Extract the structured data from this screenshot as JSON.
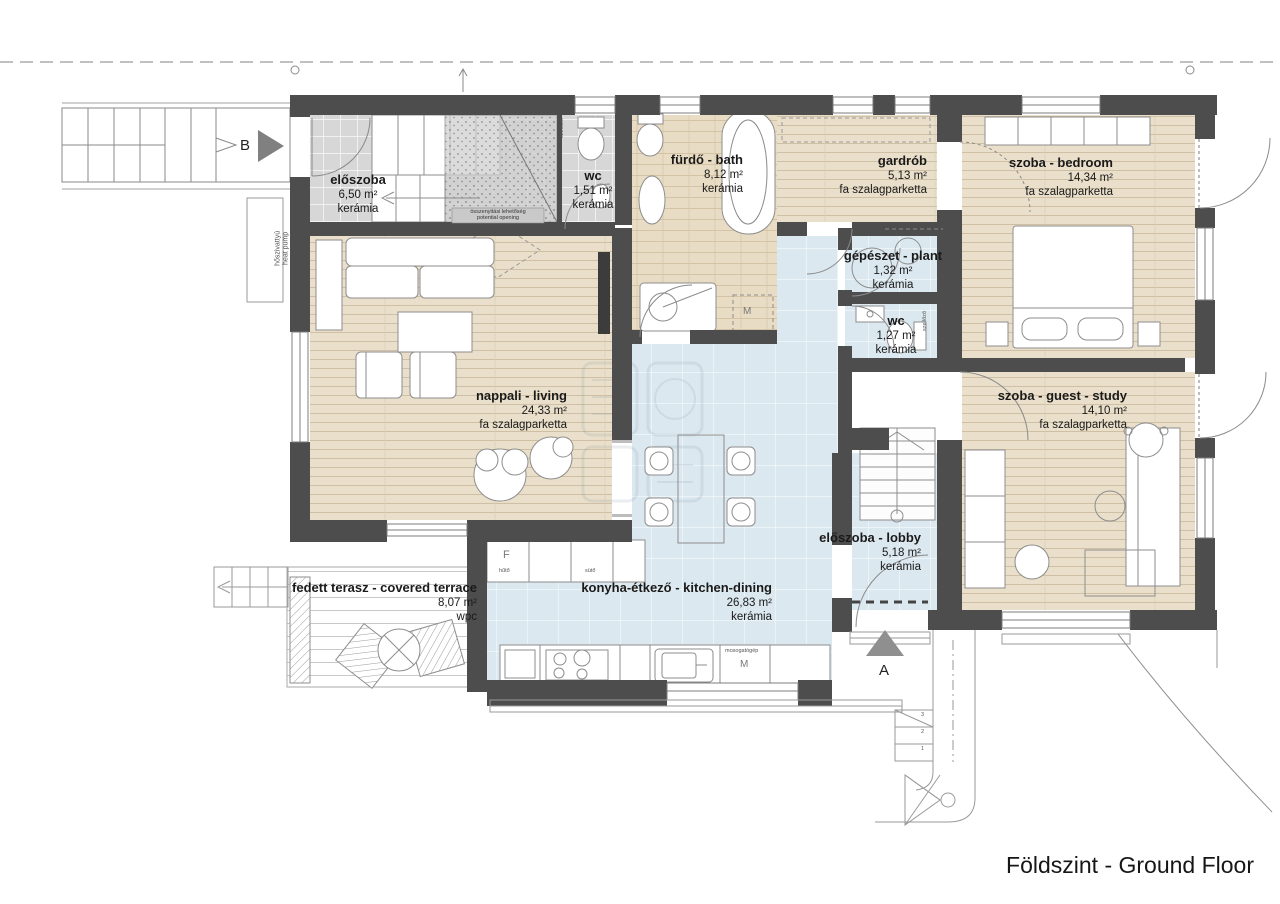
{
  "title": "Földszint - Ground Floor",
  "rooms": [
    {
      "id": "eloszoba",
      "name": "előszoba",
      "area": "6,50 m²",
      "floor": "kerámia"
    },
    {
      "id": "wc1",
      "name": "wc",
      "area": "1,51 m²",
      "floor": "kerámia"
    },
    {
      "id": "furdo",
      "name": "fürdő - bath",
      "area": "8,12 m²",
      "floor": "kerámia"
    },
    {
      "id": "gardrob",
      "name": "gardrób",
      "area": "5,13 m²",
      "floor": "fa szalagparketta"
    },
    {
      "id": "bedroom",
      "name": "szoba - bedroom",
      "area": "14,34 m²",
      "floor": "fa szalagparketta"
    },
    {
      "id": "gepeszet",
      "name": "gépészet - plant",
      "area": "1,32 m²",
      "floor": "kerámia"
    },
    {
      "id": "wc2",
      "name": "wc",
      "area": "1,27 m²",
      "floor": "kerámia"
    },
    {
      "id": "nappali",
      "name": "nappali - living",
      "area": "24,33 m²",
      "floor": "fa szalagparketta"
    },
    {
      "id": "guest",
      "name": "szoba - guest - study",
      "area": "14,10 m²",
      "floor": "fa szalagparketta"
    },
    {
      "id": "lobby",
      "name": "előszoba - lobby",
      "area": "5,18 m²",
      "floor": "kerámia"
    },
    {
      "id": "kitchen",
      "name": "konyha-étkező - kitchen-dining",
      "area": "26,83 m²",
      "floor": "kerámia"
    },
    {
      "id": "terasz",
      "name": "fedett terasz - covered terrace",
      "area": "8,07 m²",
      "floor": "wpc"
    }
  ],
  "markers": {
    "section": "B",
    "entrance": "A"
  },
  "annotations": {
    "heat_pump_line1": "hőszivattyú",
    "heat_pump_line2": "heat pump",
    "opening_line1": "összenyitási lehetőség",
    "opening_line2": "potential opening",
    "vent": "szellőző",
    "fridge_letter": "F",
    "fridge": "hűtő",
    "oven": "sütő",
    "dishwasher": "mosogatógép",
    "dishwasher_letter": "M",
    "washer_letter": "M",
    "step_numbers": [
      "1",
      "2",
      "3"
    ]
  },
  "colors": {
    "wall": "#4d4d4d",
    "wood": "#eadfca",
    "ceramic_gray": "#d7d7d7",
    "ceramic_blue": "#dce8ef",
    "deck": "#ffffff"
  }
}
